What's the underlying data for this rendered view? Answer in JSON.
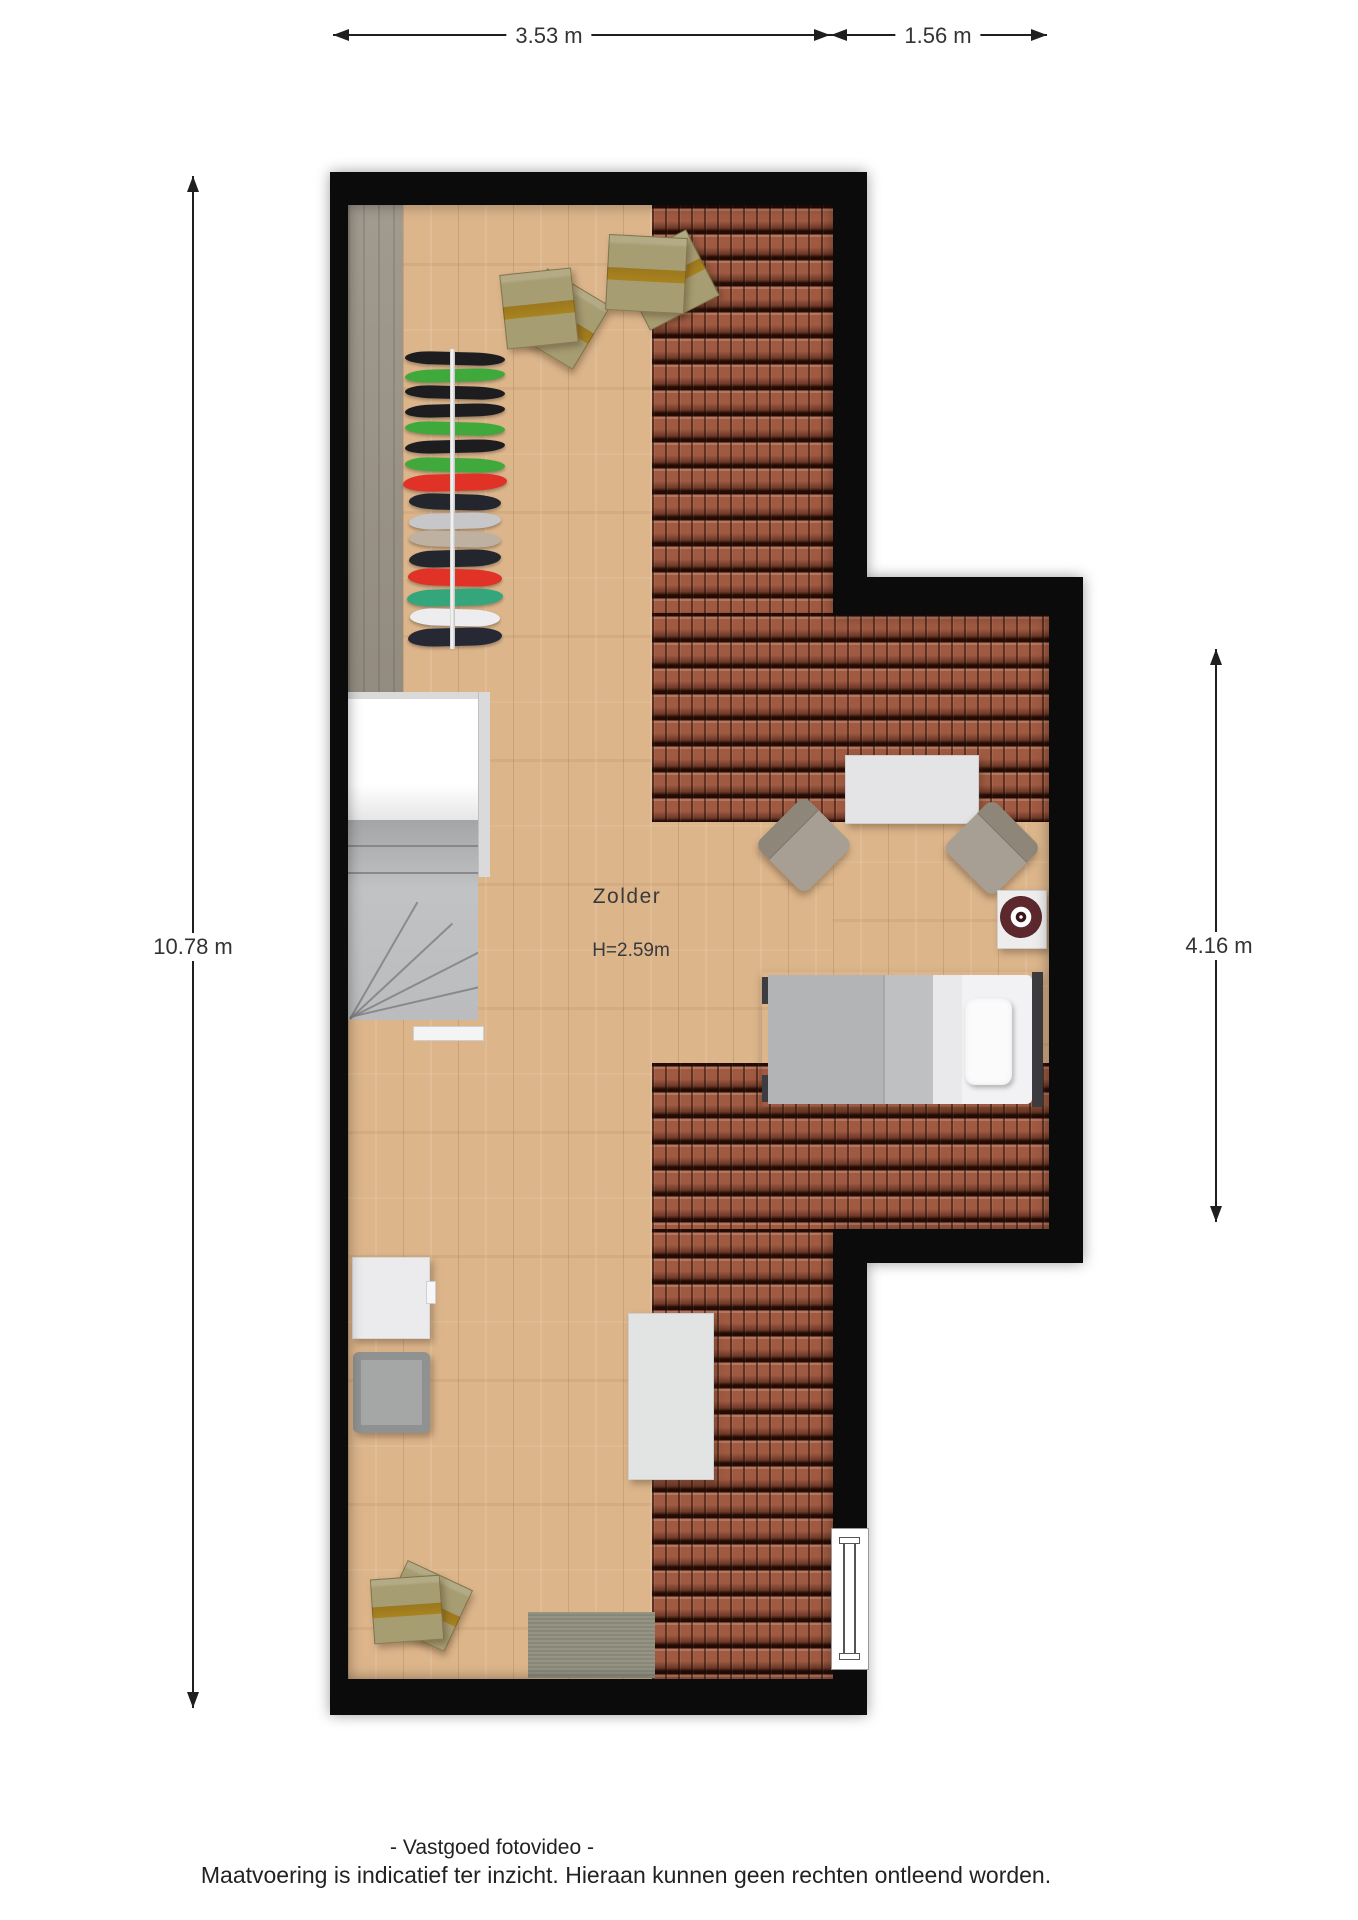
{
  "title": "Zolder floor plan",
  "room": {
    "name": "Zolder",
    "height_label": "H=2.59m"
  },
  "dimensions": {
    "top_width_main": "3.53 m",
    "top_width_annex": "1.56 m",
    "left_height": "10.78 m",
    "right_height": "4.16 m"
  },
  "footer": {
    "line1": "- Vastgoed fotovideo -",
    "line2": "Maatvoering is indicatief ter inzicht. Hieraan kunnen geen rechten ontleend worden."
  },
  "colors": {
    "wall": "#0b0b0b",
    "wood_floor": "#dcb58b",
    "roof_tiles": "#a05a42",
    "tile_gap": "#240c05",
    "knee_wall_strip": "#9c9488",
    "dimension_text": "#333333",
    "stair_gray": "#b9babc",
    "bed_blanket": "#b3b5b7",
    "record_player_disc": "#5c282e"
  },
  "furniture_labels": [
    "moving boxes",
    "moving boxes",
    "wardrobe rack with clothes",
    "staircase",
    "side table",
    "armchair",
    "armchair",
    "record player on side table",
    "single bed with pillow",
    "white cabinet",
    "gray storage cabinet",
    "work table",
    "rug",
    "moving boxes",
    "roof window"
  ],
  "wardrobe": {
    "items": [
      {
        "y": 352,
        "h": 13,
        "w": 100,
        "color": "#1d1d20"
      },
      {
        "y": 369,
        "h": 13,
        "w": 100,
        "color": "#3faa3b"
      },
      {
        "y": 386,
        "h": 13,
        "w": 100,
        "color": "#1d1d20"
      },
      {
        "y": 404,
        "h": 13,
        "w": 100,
        "color": "#1d1d20"
      },
      {
        "y": 422,
        "h": 13,
        "w": 100,
        "color": "#3faa3b"
      },
      {
        "y": 440,
        "h": 13,
        "w": 100,
        "color": "#1d1d20"
      },
      {
        "y": 458,
        "h": 14,
        "w": 100,
        "color": "#3faa3b"
      },
      {
        "y": 474,
        "h": 17,
        "w": 104,
        "color": "#e03226"
      },
      {
        "y": 494,
        "h": 16,
        "w": 92,
        "color": "#24262e"
      },
      {
        "y": 513,
        "h": 16,
        "w": 92,
        "color": "#c7c7c9"
      },
      {
        "y": 531,
        "h": 16,
        "w": 92,
        "color": "#bfb1a1"
      },
      {
        "y": 550,
        "h": 17,
        "w": 92,
        "color": "#24262e"
      },
      {
        "y": 569,
        "h": 17,
        "w": 94,
        "color": "#e03226"
      },
      {
        "y": 589,
        "h": 17,
        "w": 96,
        "color": "#35a67c"
      },
      {
        "y": 609,
        "h": 17,
        "w": 90,
        "color": "#ededef"
      },
      {
        "y": 628,
        "h": 18,
        "w": 94,
        "color": "#262833"
      }
    ]
  }
}
